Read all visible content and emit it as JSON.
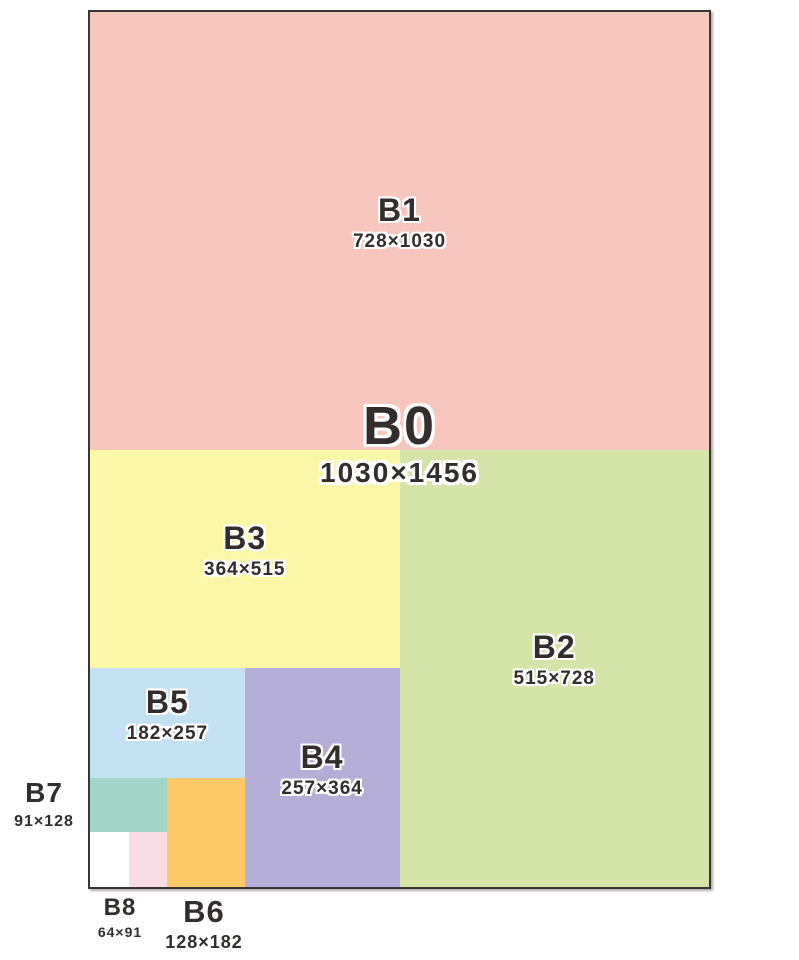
{
  "diagram": {
    "b0": {
      "name": "B0",
      "dims": "1030×1456"
    },
    "b1": {
      "name": "B1",
      "dims": "728×1030"
    },
    "b2": {
      "name": "B2",
      "dims": "515×728"
    },
    "b3": {
      "name": "B3",
      "dims": "364×515"
    },
    "b4": {
      "name": "B4",
      "dims": "257×364"
    },
    "b5": {
      "name": "B5",
      "dims": "182×257"
    },
    "b6": {
      "name": "B6",
      "dims": "128×182"
    },
    "b7": {
      "name": "B7",
      "dims": "91×128"
    },
    "b8": {
      "name": "B8",
      "dims": "64×91"
    }
  },
  "colors": {
    "b1": "#f7c6bd",
    "b2": "#d5e4a9",
    "b3": "#fcf7a7",
    "b4": "#b5aed6",
    "b5": "#c3e1f2",
    "b6": "#fbc968",
    "b7": "#a2d5c8",
    "b8": "#ffffff",
    "b9": "#f9dbe5",
    "border": "#3b3434",
    "text": "#342d2d",
    "text_outline": "#ffffff",
    "background": "#ffffff"
  }
}
